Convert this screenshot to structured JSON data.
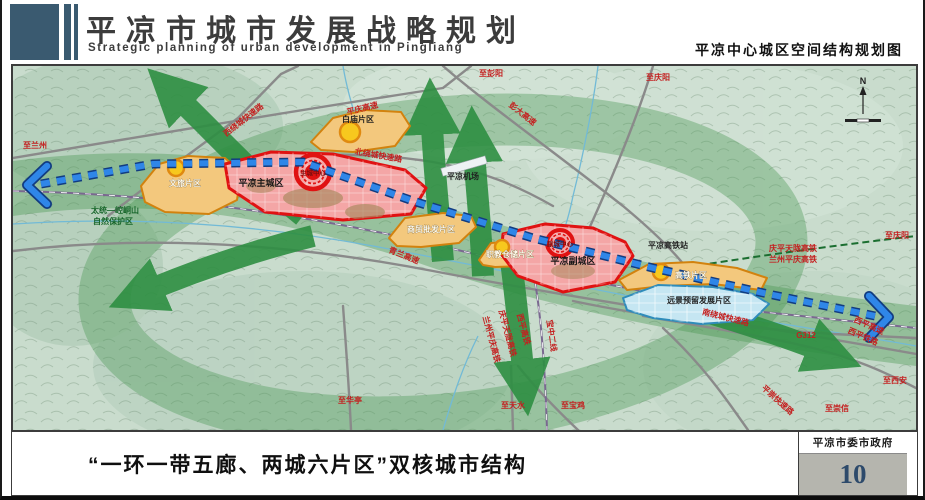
{
  "header": {
    "title": "平凉市城市发展战略规划",
    "subtitle_en": "Strategic planning of urban development in Pingliang",
    "map_name": "平凉中心城区空间结构规划图"
  },
  "footer": {
    "caption": "“一环一带五廊、两城六片区”双核城市结构",
    "authority": "平凉市委市政府",
    "page_number": "10"
  },
  "colors": {
    "header_blue": "#3a5a70",
    "page_number_blue": "#2d4a6b",
    "road_label_red": "#c41f1f",
    "corridor_green": "#2e8f42",
    "axis_blue": "#2f86e8",
    "main_city_red": "#e01212",
    "district_orange": "#d2820e",
    "reserve_area_blue": "#2f8cba"
  },
  "map": {
    "compass_label": "N",
    "labels": [
      {
        "text": "至兰州",
        "x": 22,
        "y": 82,
        "cls": "red"
      },
      {
        "text": "至彭阳",
        "x": 478,
        "y": 10,
        "cls": "red"
      },
      {
        "text": "至庆阳",
        "x": 645,
        "y": 14,
        "cls": "red"
      },
      {
        "text": "彭大高速",
        "x": 508,
        "y": 50,
        "cls": "red",
        "rot": 38
      },
      {
        "text": "平庆高速",
        "x": 350,
        "y": 45,
        "cls": "red",
        "rot": -14
      },
      {
        "text": "西绕城快速路",
        "x": 232,
        "y": 56,
        "cls": "red",
        "rot": -38
      },
      {
        "text": "北绕城快速路",
        "x": 365,
        "y": 92,
        "cls": "red",
        "rot": 10
      },
      {
        "text": "白庙片区",
        "x": 345,
        "y": 56,
        "cls": "dark"
      },
      {
        "text": "平凉主城区",
        "x": 248,
        "y": 120,
        "cls": "city"
      },
      {
        "text": "主城中心",
        "x": 300,
        "y": 109,
        "cls": "center"
      },
      {
        "text": "文旅片区",
        "x": 172,
        "y": 120,
        "cls": "area"
      },
      {
        "text": "商贸批发片区",
        "x": 418,
        "y": 166,
        "cls": "area"
      },
      {
        "text": "职教仓储片区",
        "x": 497,
        "y": 191,
        "cls": "area"
      },
      {
        "text": "平凉副城区",
        "x": 560,
        "y": 198,
        "cls": "city"
      },
      {
        "text": "副城中心",
        "x": 547,
        "y": 180,
        "cls": "center"
      },
      {
        "text": "平凉高铁站",
        "x": 655,
        "y": 182,
        "cls": "dark"
      },
      {
        "text": "高铁片区",
        "x": 678,
        "y": 212,
        "cls": "area"
      },
      {
        "text": "远景预留发展片区",
        "x": 686,
        "y": 237,
        "cls": "dark"
      },
      {
        "text": "平凉机场",
        "x": 450,
        "y": 113,
        "cls": "dark"
      },
      {
        "text": "青兰高速",
        "x": 390,
        "y": 192,
        "cls": "red",
        "rot": 22
      },
      {
        "text": "太统—崆峒山",
        "x": 102,
        "y": 147,
        "cls": "green"
      },
      {
        "text": "自然保护区",
        "x": 100,
        "y": 158,
        "cls": "green"
      },
      {
        "text": "庆平天陇高铁",
        "x": 780,
        "y": 185,
        "cls": "red"
      },
      {
        "text": "兰州平庆高铁",
        "x": 780,
        "y": 196,
        "cls": "red"
      },
      {
        "text": "至庆阳",
        "x": 884,
        "y": 172,
        "cls": "red"
      },
      {
        "text": "南绕城快速路",
        "x": 712,
        "y": 254,
        "cls": "red",
        "rot": 14
      },
      {
        "text": "G312",
        "x": 793,
        "y": 272,
        "cls": "red"
      },
      {
        "text": "西平高速",
        "x": 855,
        "y": 262,
        "cls": "red",
        "rot": 24
      },
      {
        "text": "西平铁路",
        "x": 849,
        "y": 273,
        "cls": "red",
        "rot": 24
      },
      {
        "text": "至西安",
        "x": 882,
        "y": 317,
        "cls": "red"
      },
      {
        "text": "至崇信",
        "x": 824,
        "y": 345,
        "cls": "red"
      },
      {
        "text": "平崇快速路",
        "x": 763,
        "y": 336,
        "cls": "red",
        "rot": 42
      },
      {
        "text": "至华亭",
        "x": 337,
        "y": 337,
        "cls": "red"
      },
      {
        "text": "至天水",
        "x": 500,
        "y": 342,
        "cls": "red"
      },
      {
        "text": "至宝鸡",
        "x": 560,
        "y": 342,
        "cls": "red"
      },
      {
        "text": "宝中二线",
        "x": 536,
        "y": 270,
        "cls": "red",
        "rot": 82
      },
      {
        "text": "西平高铁",
        "x": 508,
        "y": 264,
        "cls": "red",
        "rot": 75
      },
      {
        "text": "庆平天陇高铁",
        "x": 492,
        "y": 268,
        "cls": "red",
        "rot": 75
      },
      {
        "text": "兰州平庆高铁",
        "x": 476,
        "y": 274,
        "cls": "red",
        "rot": 75
      }
    ]
  }
}
